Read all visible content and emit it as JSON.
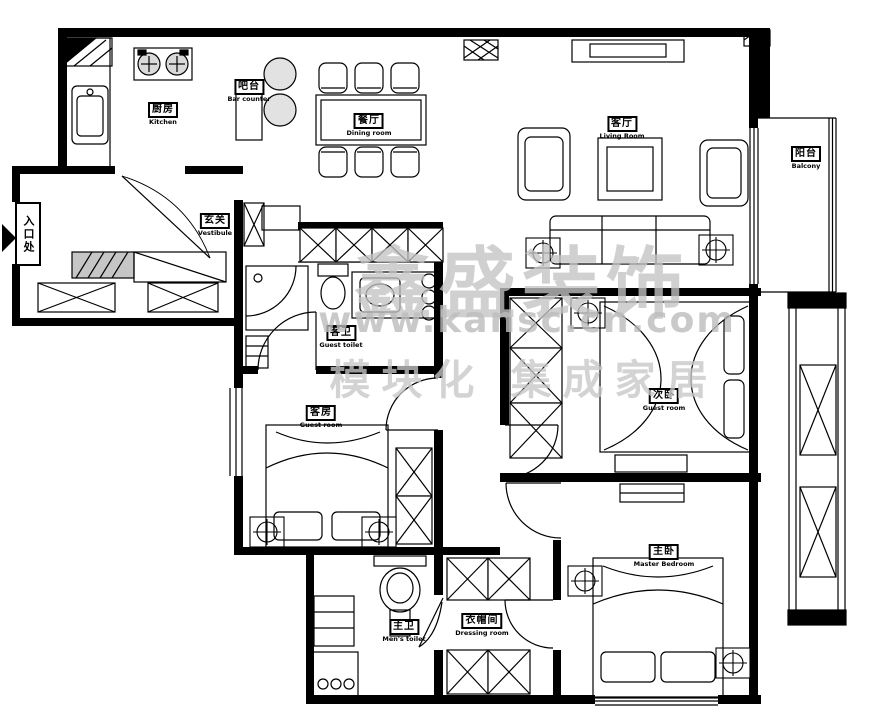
{
  "title": "apartment-floor-plan",
  "colors": {
    "wall": "#000000",
    "background": "#ffffff",
    "watermark": "#c3c3c3",
    "hatch_fill": "#d9d9d9"
  },
  "watermark": {
    "brand": "鑫盛装饰",
    "url": "www.kansc.cn.com",
    "tagline": "模块化 集成家居"
  },
  "rooms": {
    "kitchen": {
      "zh": "厨房",
      "en": "Kitchen"
    },
    "bar": {
      "zh": "吧台",
      "en": "Bar counter"
    },
    "dining": {
      "zh": "餐厅",
      "en": "Dining room"
    },
    "living": {
      "zh": "客厅",
      "en": "Living Room"
    },
    "balcony": {
      "zh": "阳台",
      "en": "Balcony"
    },
    "entrance": {
      "zh": "入口处"
    },
    "vestibule": {
      "zh": "玄关",
      "en": "Vestibule"
    },
    "guest_toilet": {
      "zh": "客卫",
      "en": "Guest toilet"
    },
    "guest_room_left": {
      "zh": "客房",
      "en": "Guest room"
    },
    "guest_room_right": {
      "zh": "次卧",
      "en": "Guest room"
    },
    "master_bedroom": {
      "zh": "主卧",
      "en": "Master Bedroom"
    },
    "master_toilet": {
      "zh": "主卫",
      "en": "Men's toilet"
    },
    "dressing": {
      "zh": "衣帽间",
      "en": "Dressing room"
    }
  }
}
